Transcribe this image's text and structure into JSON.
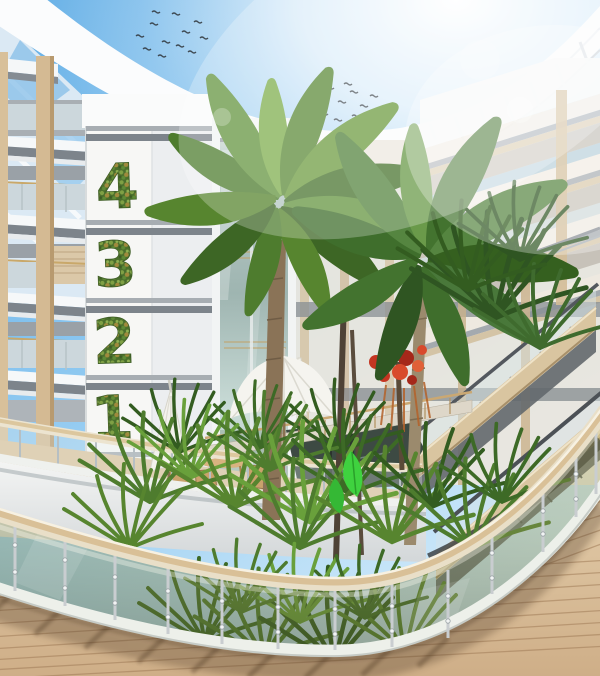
{
  "meta": {
    "title": "Tropical atrium courtyard — architectural rendering",
    "description": "Circular multi-storey hotel atrium with glass roof ring, palm garden, cafe terrace, escalators and curved glass-railed boardwalk"
  },
  "signage": {
    "style": "living plant mosaic numerals on white atrium column",
    "floor_numbers": [
      {
        "label": "4"
      },
      {
        "label": "3"
      },
      {
        "label": "2"
      },
      {
        "label": "1"
      }
    ]
  },
  "scene_elements": [
    "sky",
    "sun-glare",
    "birds-flock",
    "glass-roof-ring",
    "skylight",
    "left-balconies",
    "green-wall-number-column",
    "glass-elevator",
    "cafe-terrace",
    "umbrella-open",
    "umbrella-closed",
    "cafe-furniture",
    "palm-trees",
    "red-flowering-tree",
    "understory-plants",
    "water-pool",
    "bridge-walkway",
    "escalators",
    "right-balconies",
    "curved-glass-railing",
    "wood-deck"
  ],
  "palette": {
    "sky_blue": "#6cb6e9",
    "sun_glare": "#ffffff",
    "structure_white": "#f6f8f9",
    "slab_gray": "#7d848b",
    "timber": "#d4ba93",
    "deck_wood": "#d7bb97",
    "foliage_dark": "#33591f",
    "foliage_mid": "#57852f",
    "foliage_light": "#8cb94e",
    "flower_red": "#cf3a22",
    "glass_tint": "#8f9452",
    "water": "#3d4a43",
    "handrail_cream": "#e9dfc8"
  }
}
